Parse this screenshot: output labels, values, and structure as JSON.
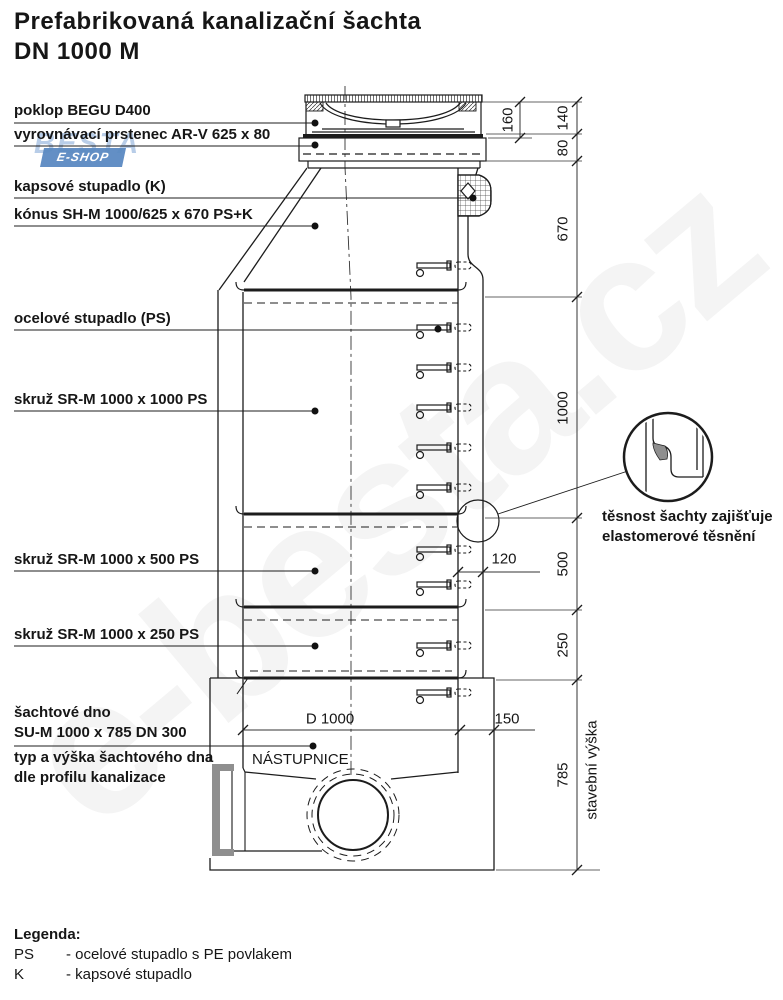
{
  "title": {
    "line1": "Prefabrikovaná kanalizační šachta",
    "line2": "DN 1000 M"
  },
  "watermark": {
    "diagonal_text": "e-besta.cz",
    "logo_name": "BESTA",
    "logo_sub": "E-SHOP"
  },
  "labels": [
    {
      "text": "poklop BEGU D400"
    },
    {
      "text": "vyrovnávací prstenec AR-V 625 x 80"
    },
    {
      "text": "kapsové stupadlo (K)"
    },
    {
      "text": "kónus SH-M 1000/625 x 670 PS+K"
    },
    {
      "text": "ocelové stupadlo (PS)"
    },
    {
      "text": "skruž SR-M 1000 x 1000 PS"
    },
    {
      "text": "skruž SR-M 1000 x 500 PS"
    },
    {
      "text": "skruž SR-M 1000 x 250 PS"
    },
    {
      "text": "šachtové dno",
      "text2": "SU-M 1000 x 785 DN 300"
    },
    {
      "text": "typ a výška šachtového dna",
      "text2": "dle profilu kanalizace"
    }
  ],
  "dimensions": {
    "d160": "160",
    "d140": "140",
    "d80": "80",
    "d670": "670",
    "d1000": "1000",
    "d500": "500",
    "d250": "250",
    "d785": "785",
    "d120": "120",
    "d150": "150",
    "inner_diameter": "D 1000",
    "building_height": "stavební výška"
  },
  "annotations": {
    "nastupnice": "NÁSTUPNICE",
    "seal_line1": "těsnost šachty zajišťuje",
    "seal_line2": "elastomerové těsnění"
  },
  "legend": {
    "heading": "Legenda:",
    "items": [
      {
        "key": "PS",
        "desc": "- ocelové stupadlo s PE povlakem"
      },
      {
        "key": "K",
        "desc": "- kapsové stupadlo"
      }
    ]
  },
  "colors": {
    "drawing_line": "#1c1c1c",
    "seal_gray": "#8f8f8f",
    "pipe_socket_gray": "#8f8f8f",
    "logo_blue": "#5b8ac2",
    "logo_light_blue": "#b5cbe7"
  }
}
